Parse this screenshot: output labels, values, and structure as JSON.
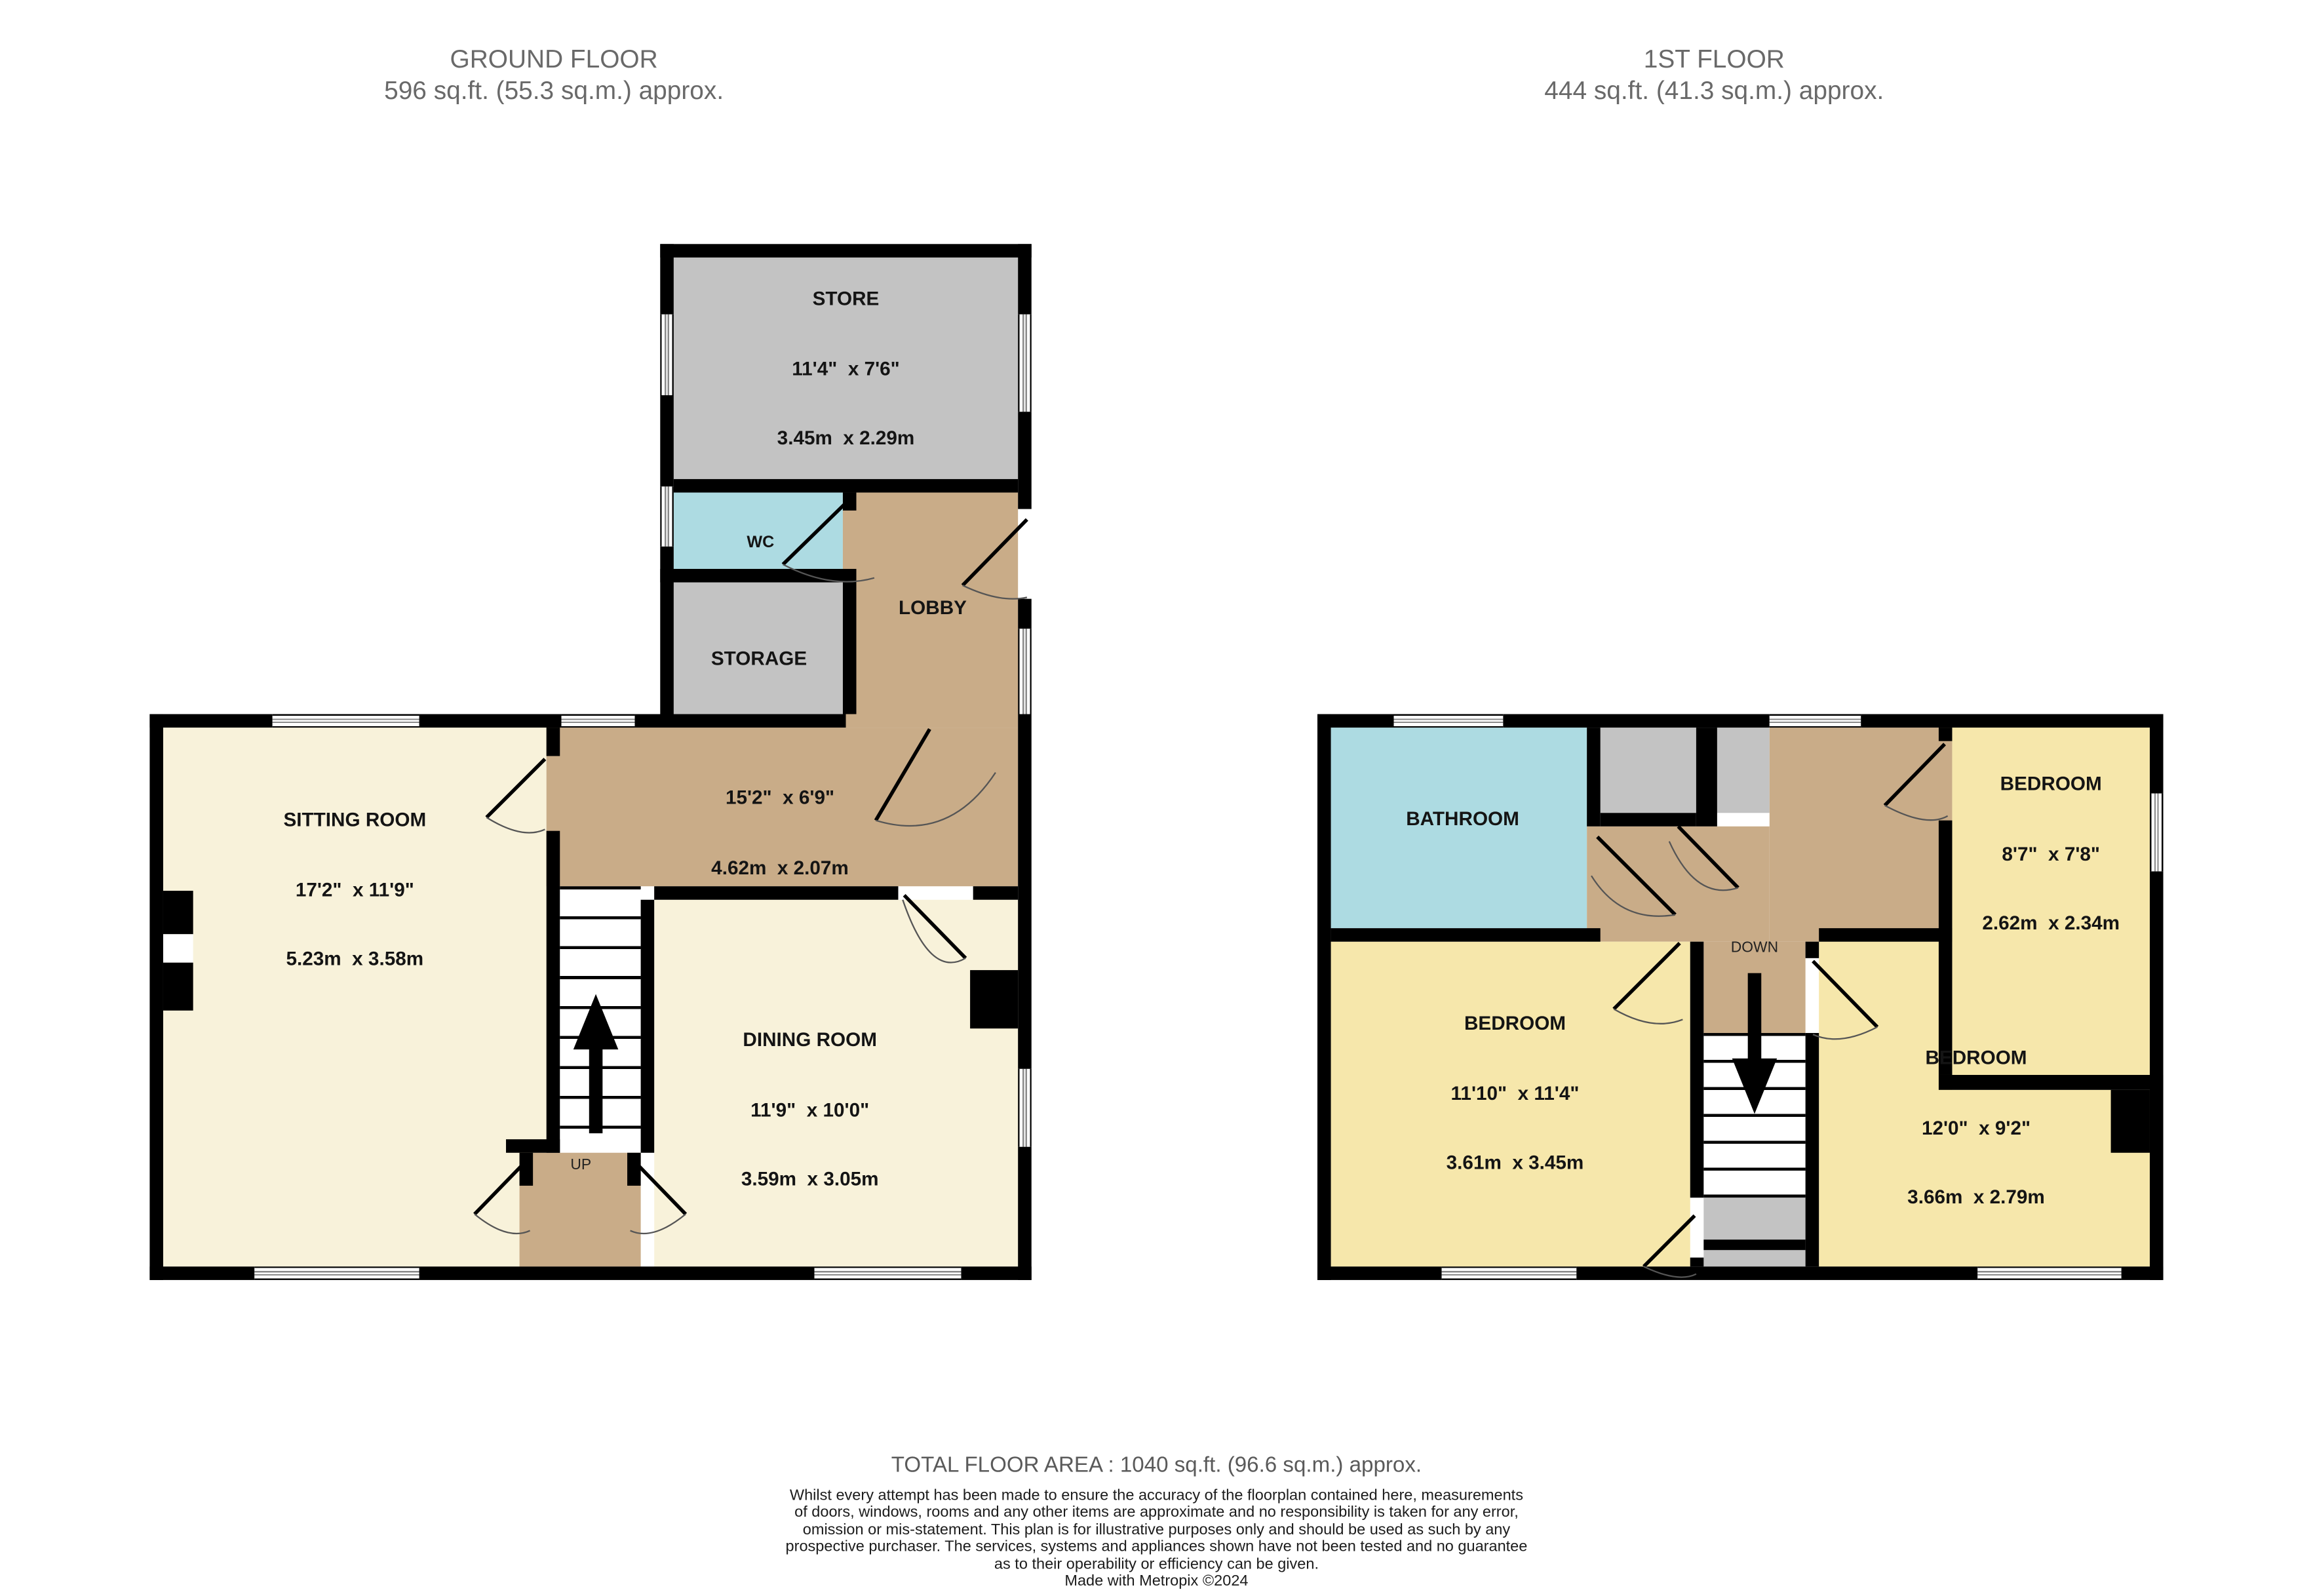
{
  "ground_floor": {
    "title": "GROUND FLOOR",
    "area": "596 sq.ft. (55.3 sq.m.) approx.",
    "rooms": {
      "store": {
        "name": "STORE",
        "imperial": "11'4\"  x 7'6\"",
        "metric": "3.45m  x 2.29m"
      },
      "wc": {
        "name": "WC"
      },
      "lobby": {
        "name": "LOBBY"
      },
      "storage": {
        "name": "STORAGE"
      },
      "hallway": {
        "imperial": "15'2\"  x 6'9\"",
        "metric": "4.62m  x 2.07m"
      },
      "sitting": {
        "name": "SITTING ROOM",
        "imperial": "17'2\"  x 11'9\"",
        "metric": "5.23m  x 3.58m"
      },
      "dining": {
        "name": "DINING ROOM",
        "imperial": "11'9\"  x 10'0\"",
        "metric": "3.59m  x 3.05m"
      }
    },
    "stair_label": "UP"
  },
  "first_floor": {
    "title": "1ST FLOOR",
    "area": "444 sq.ft. (41.3 sq.m.) approx.",
    "rooms": {
      "bathroom": {
        "name": "BATHROOM"
      },
      "bedroom_top_right": {
        "name": "BEDROOM",
        "imperial": "8'7\"  x 7'8\"",
        "metric": "2.62m  x 2.34m"
      },
      "bedroom_left": {
        "name": "BEDROOM",
        "imperial": "11'10\"  x 11'4\"",
        "metric": "3.61m  x 3.45m"
      },
      "bedroom_bottom_right": {
        "name": "BEDROOM",
        "imperial": "12'0\"  x 9'2\"",
        "metric": "3.66m  x 2.79m"
      }
    },
    "stair_label": "DOWN"
  },
  "footer": {
    "total_area": "TOTAL FLOOR AREA : 1040 sq.ft. (96.6 sq.m.) approx.",
    "disclaimer_lines": [
      "Whilst every attempt has been made to ensure the accuracy of the floorplan contained here, measurements",
      "of doors, windows, rooms and any other items are approximate and no responsibility is taken for any error,",
      "omission or mis-statement. This plan is for illustrative purposes only and should be used as such by any",
      "prospective purchaser. The services, systems and appliances shown have not been tested and no guarantee",
      "as to their operability or efficiency can be given."
    ],
    "credit": "Made with Metropix ©2024"
  },
  "colors": {
    "wall": "#000000",
    "room_cream": "#f8f2da",
    "room_yellow": "#f6e7ab",
    "room_tan": "#c9ac88",
    "room_blue": "#addbe2",
    "room_gray": "#c3c3c3",
    "title_gray": "#696969"
  }
}
